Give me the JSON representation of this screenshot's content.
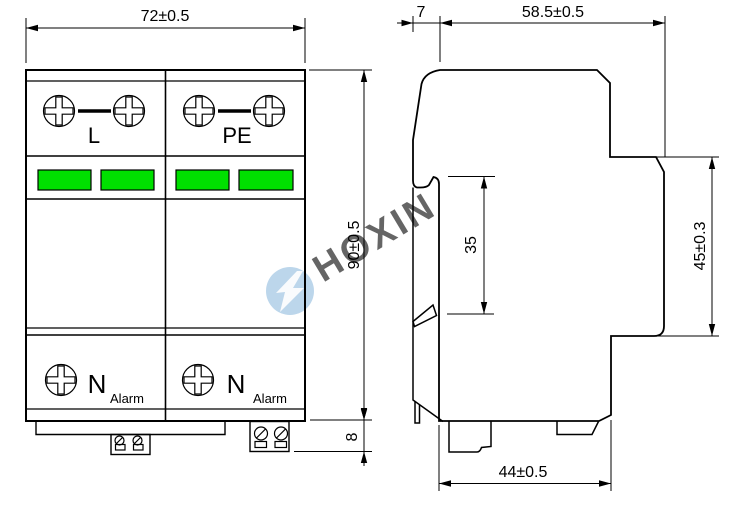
{
  "watermark": {
    "brand": "HOXIN",
    "color": "#8fbcdf"
  },
  "front_view": {
    "dim_width": "72±0.5",
    "dim_height": "90±0.5",
    "dim_terminal_height": "8",
    "indicator_color": "#00e000",
    "modules": [
      {
        "terminal_top": "L",
        "terminal_bottom": "N",
        "alarm": "Alarm"
      },
      {
        "terminal_top": "PE",
        "terminal_bottom": "N",
        "alarm": "Alarm"
      }
    ]
  },
  "side_view": {
    "dim_front_ledge": "7",
    "dim_depth": "58.5±0.5",
    "dim_din_rail": "35",
    "dim_rear_height": "45±0.3",
    "dim_base_depth": "44±0.5"
  }
}
